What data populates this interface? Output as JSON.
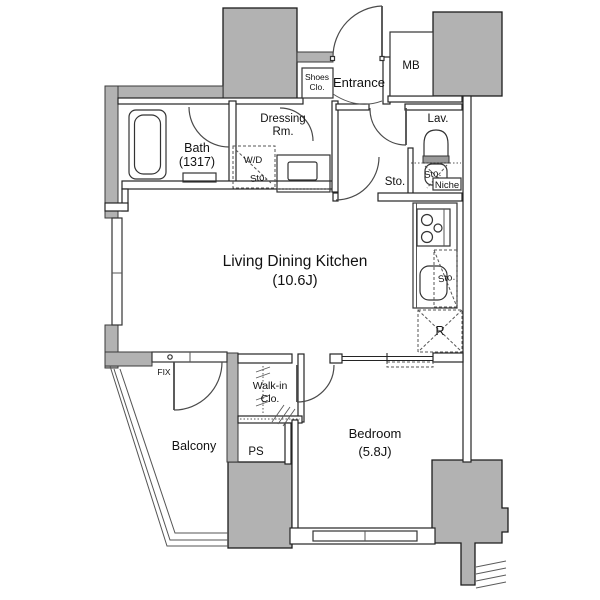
{
  "plan": {
    "rooms": {
      "ldk": {
        "name": "Living Dining Kitchen",
        "size": "(10.6J)"
      },
      "bedroom": {
        "name": "Bedroom",
        "size": "(5.8J)"
      },
      "bath": {
        "name": "Bath",
        "size": "(1317)"
      },
      "dressing": {
        "line1": "Dressing",
        "line2": "Rm."
      },
      "walk_in": {
        "line1": "Walk-in",
        "line2": "Clo."
      },
      "entrance": {
        "name": "Entrance"
      },
      "balcony": {
        "name": "Balcony"
      },
      "lavatory": {
        "name": "Lav."
      },
      "meter_box": {
        "name": "MB"
      },
      "pipe_space": {
        "name": "PS"
      }
    },
    "fixtures": {
      "shoes_closet": {
        "line1": "Shoes",
        "line2": "Clo."
      },
      "washer_dryer": {
        "label": "W/D",
        "sub": "Sto."
      },
      "hall_storage": {
        "label": "Sto."
      },
      "lavatory_storage": {
        "label": "Sto."
      },
      "kitchen_storage": {
        "label": "Sto."
      },
      "niche": {
        "label": "Niche"
      },
      "refrigerator": {
        "label": "R"
      },
      "fixed_window": {
        "label": "FIX"
      }
    },
    "colors": {
      "wall_gray": "#b2b2b2",
      "line": "#222222",
      "background": "#ffffff"
    }
  }
}
